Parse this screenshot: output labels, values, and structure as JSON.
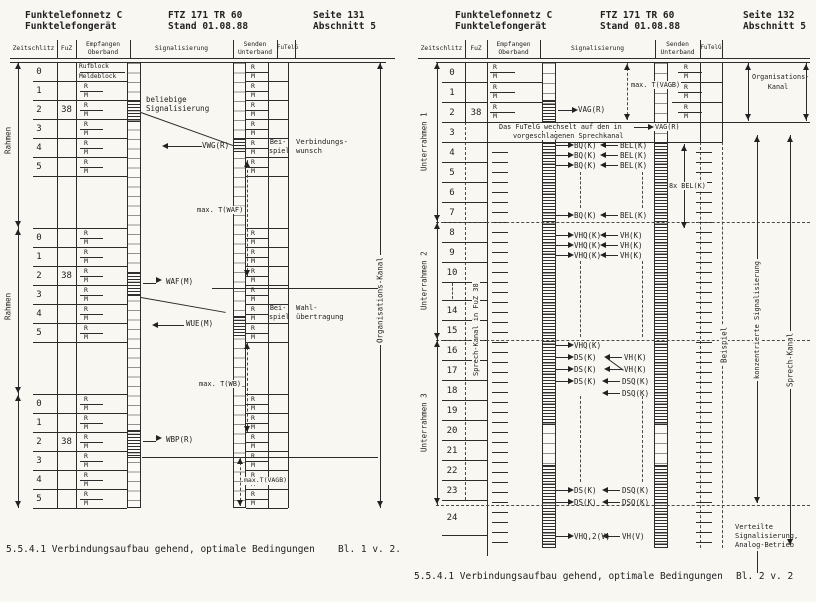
{
  "page1": {
    "header": {
      "product1": "Funktelefonnetz C",
      "product2": "Funktelefongerät",
      "doc1": "FTZ 171 TR 60",
      "doc2": "Stand 01.08.88",
      "seite": "Seite 131",
      "abschnitt": "Abschnitt 5"
    },
    "columns": {
      "zeitschlitz": "Zeitschlitz",
      "fuz": "FuZ",
      "empfangen1": "Empfangen",
      "empfangen2": "Oberband",
      "signalisierung": "Signalisierung",
      "senden1": "Senden",
      "senden2": "Unterband",
      "futelg": "FuTelG"
    },
    "side_label": "Rahmen",
    "org_label": "Organisations-Kanal",
    "slot_numbers": [
      "0",
      "1",
      "2",
      "3",
      "4",
      "5"
    ],
    "fuz_value": "38",
    "rm": [
      "R",
      "M"
    ],
    "rx_first": [
      "Rufblock",
      "Meldeblock"
    ],
    "labels": {
      "beliebige": [
        "beliebige",
        "Signalisierung"
      ],
      "vwg": "VWG(R)",
      "waf": "WAF(M)",
      "wue": "WUE(M)",
      "wbp": "WBP(R)",
      "t_waf": "max. T(WAF)",
      "t_wb": "max. T(WB)",
      "t_vagb": "max.T(VAGB)",
      "beispiel": [
        "Bei-",
        "spiel"
      ],
      "verbindungswunsch": [
        "Verbindungs-",
        "wunsch"
      ],
      "wahl": [
        "Wahl-",
        "übertragung"
      ]
    },
    "caption": "5.5.4.1 Verbindungsaufbau gehend, optimale Bedingungen",
    "sheet": "Bl. 1 v. 2."
  },
  "page2": {
    "header": {
      "product1": "Funktelefonnetz C",
      "product2": "Funktelefongerät",
      "doc1": "FTZ 171 TR 60",
      "doc2": "Stand 01.08.88",
      "seite": "Seite 132",
      "abschnitt": "Abschnitt 5"
    },
    "columns": {
      "zeitschlitz": "Zeitschlitz",
      "fuz": "FuZ",
      "empfangen1": "Empfangen",
      "empfangen2": "Oberband",
      "signalisierung": "Signalisierung",
      "senden1": "Senden",
      "senden2": "Unterband",
      "futelg": "FuTelG"
    },
    "unterrahmen": [
      "Unterrahmen 1",
      "Unterrahmen 2",
      "Unterrahmen 3"
    ],
    "sprechkanal_fuz": "Sprech-Kanal in FuZ 38",
    "slot_numbers": [
      "0",
      "1",
      "2",
      "3",
      "4",
      "5",
      "6",
      "7",
      "8",
      "9",
      "10",
      "14",
      "15",
      "16",
      "17",
      "18",
      "19",
      "20",
      "21",
      "22",
      "23",
      "24"
    ],
    "fuz_value": "38",
    "rm": [
      "R",
      "M"
    ],
    "labels": {
      "vag": "VAG(R)",
      "t_vagb": "max. T(VAGB)",
      "org": [
        "Organisations-",
        "Kanal"
      ],
      "wechsel": [
        "Das FuTelG wechselt auf den in",
        "vorgeschlagenen Sprechkanal"
      ],
      "bq": "BQ(K)",
      "bel": "BEL(K)",
      "bel8": "8x BEL(K)",
      "vhq": "VHQ(K)",
      "vh": "VH(K)",
      "ds": "DS(K)",
      "dsq": "DSQ(K)",
      "vhq2": "VHQ,2(V)",
      "vhv": "VH(V)",
      "beispiel": "Beispiel",
      "konzentriert": "konzentrierte Signalisierung",
      "sprechkanal": "Sprech-Kanal",
      "verteilt": [
        "Verteilte",
        "Signalisierung,",
        "Analog-Betrieb"
      ]
    },
    "caption": "5.5.4.1 Verbindungsaufbau gehend, optimale Bedingungen",
    "sheet": "Bl. 2 v. 2"
  }
}
